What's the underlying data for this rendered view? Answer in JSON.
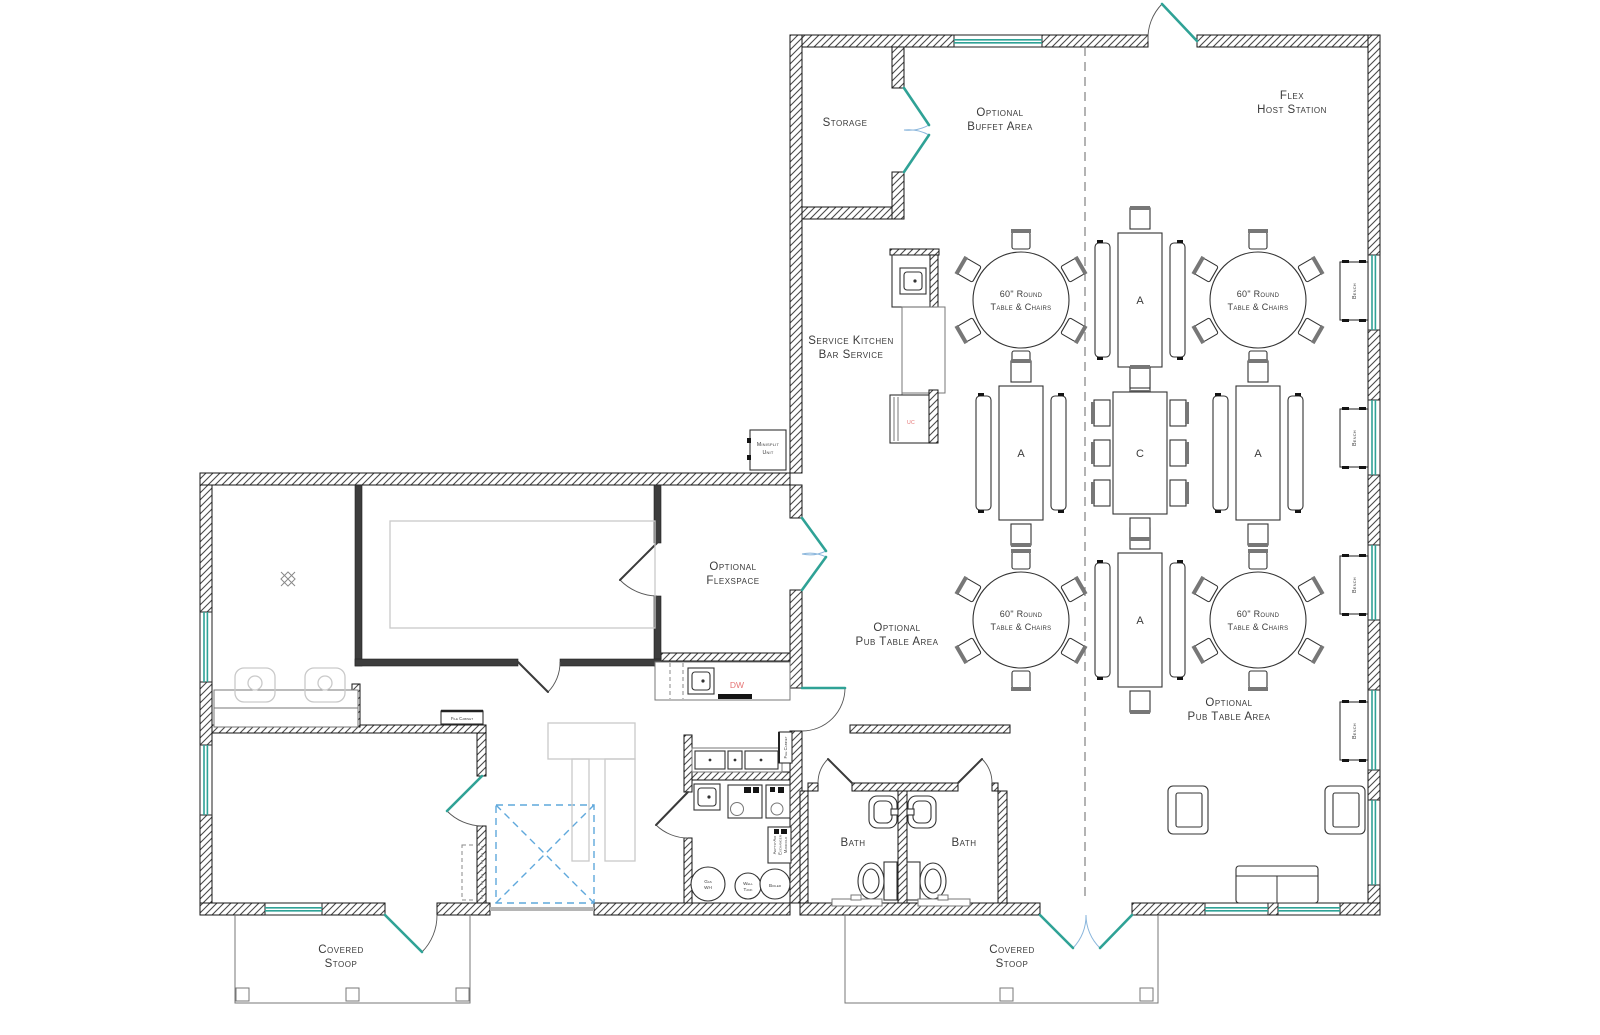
{
  "document": {
    "type": "architectural floor plan"
  },
  "colors": {
    "wall_line": "#141414",
    "window_glass": "#2fa296",
    "door_leaf": "#2fa296",
    "swing_arc_blue": "#8ab6dc",
    "optional_dashed_blue": "#5fa8dc",
    "annotation_red": "#e57373",
    "ghost_furniture": "#c9c9c9",
    "divider_dash": "#8a8a8a",
    "text": "#3a3a3a"
  },
  "rooms": {
    "storage": {
      "label": "Storage"
    },
    "buffet": {
      "label": [
        "Optional",
        "Buffet Area"
      ]
    },
    "flex_host": {
      "label": [
        "Flex",
        "Host Station"
      ]
    },
    "service_kitchen": {
      "label": [
        "Service Kitchen",
        "Bar Service"
      ]
    },
    "pub_area_left": {
      "label": [
        "Optional",
        "Pub Table Area"
      ]
    },
    "pub_area_right": {
      "label": [
        "Optional",
        "Pub Table Area"
      ]
    },
    "flexspace": {
      "label": [
        "Optional",
        "Flexspace"
      ]
    },
    "bath_left": {
      "label": "Bath"
    },
    "bath_right": {
      "label": "Bath"
    },
    "stoop_left": {
      "label": [
        "Covered",
        "Stoop"
      ]
    },
    "stoop_right": {
      "label": [
        "Covered",
        "Stoop"
      ]
    }
  },
  "furniture": {
    "round_table_label": [
      "60\" Round",
      "Table & Chairs"
    ],
    "table_type_a": "A",
    "table_type_c": "C",
    "bench_label": "Bench",
    "file_cabinet_label": "File Cabinet",
    "minisplit_label": [
      "Minisplit",
      "Unit"
    ]
  },
  "equipment": {
    "gas_water_heater": [
      "Gas",
      "WH"
    ],
    "well_tank": [
      "Well",
      "Tank"
    ],
    "boiler": "Boiler",
    "air_exchanger": [
      "Air-to-Air",
      "Exchanger",
      "Manifold"
    ],
    "dishwasher": "DW",
    "undercounter": "UC"
  }
}
